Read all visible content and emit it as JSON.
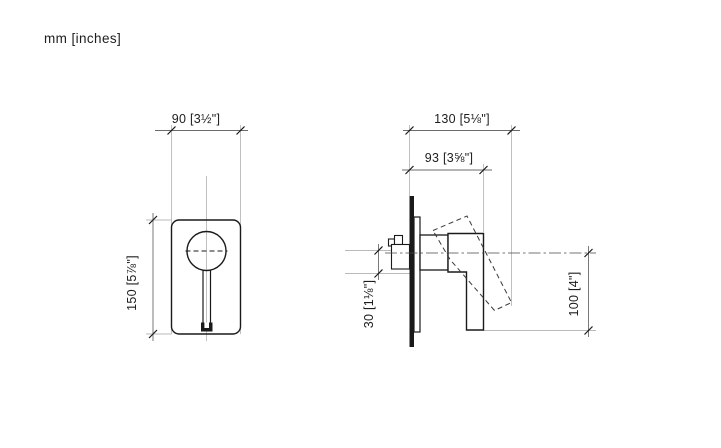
{
  "units_label": "mm [inches]",
  "drawing": {
    "type": "technical-dimension-drawing",
    "views": {
      "front": {
        "width_label": "90 [3½\"]",
        "height_label": "150 [5⅞\"]"
      },
      "side": {
        "max_depth_label": "130 [5⅛\"]",
        "body_depth_label": "93 [3⅝\"]",
        "center_offset_label": "30 [1⅛\"]",
        "lever_drop_label": "100 [4\"]"
      }
    }
  }
}
